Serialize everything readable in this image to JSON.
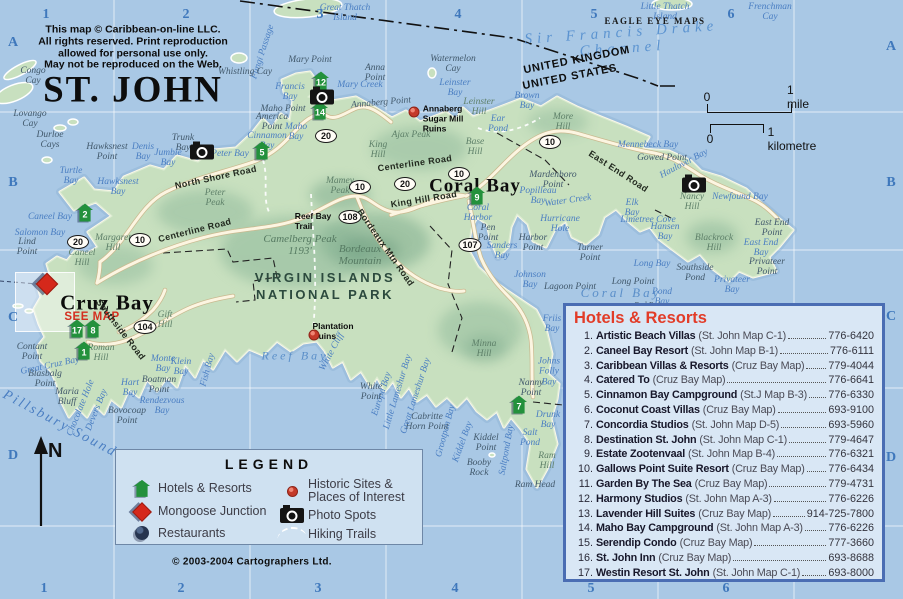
{
  "title": "ST. JOHN",
  "copyright_notice": "This map © Caribbean-on-line LLC.\nAll rights reserved. Print reproduction\nallowed for personal use only.\nMay not be reproduced on the Web.",
  "credit": "© 2003-2004 Cartographers Ltd.",
  "compass_n": "N",
  "colors": {
    "water": "#a9c8e5",
    "land": "#c8e0bf",
    "panel_bg": "#d9e7f5",
    "panel_border": "#4a6db3",
    "header_red": "#e23c28",
    "marker_green": "#23913c",
    "diamond_red": "#d5281b",
    "grid_label_blue": "#3f78bc",
    "water_label_blue": "#4a7ec2"
  },
  "scale_bar": {
    "mile_zero": "0",
    "mile_label": "1 mile",
    "km_zero": "0",
    "km_label": "1 kilometre"
  },
  "grid": {
    "cols": [
      "1",
      "2",
      "3",
      "4",
      "5",
      "6"
    ],
    "rows": [
      "A",
      "B",
      "C",
      "D"
    ],
    "top_xs": [
      46,
      186,
      320,
      458,
      594,
      731
    ],
    "top_y": 15,
    "bottom_xs": [
      44,
      181,
      318,
      455,
      591,
      726
    ],
    "bottom_y": 589,
    "left_x": 13,
    "left_ys": [
      43,
      183,
      318,
      456
    ],
    "right_x": 891,
    "right_ys": [
      47,
      183,
      317,
      458
    ]
  },
  "legend": {
    "title": "LEGEND",
    "left": [
      {
        "icon": "hotel-icon",
        "label": "Hotels & Resorts"
      },
      {
        "icon": "mongoose-junction-icon",
        "label": "Mongoose Junction"
      },
      {
        "icon": "restaurant-icon",
        "label": "Restaurants"
      }
    ],
    "right": [
      {
        "icon": "historic-site-icon",
        "label": "Historic Sites &\nPlaces of Interest"
      },
      {
        "icon": "photo-spot-icon",
        "label": "Photo Spots"
      },
      {
        "icon": "hiking-trail-icon",
        "label": "Hiking Trails"
      }
    ]
  },
  "hotels_panel": {
    "title": "Hotels & Resorts",
    "items": [
      {
        "num": "1.",
        "name": "Artistic Beach Villas",
        "note": "(St. John Map C-1)",
        "phone": "776-6420"
      },
      {
        "num": "2.",
        "name": "Caneel Bay Resort",
        "note": "(St. John Map B-1)",
        "phone": "776-6111"
      },
      {
        "num": "3.",
        "name": "Caribbean Villas & Resorts",
        "note": "(Cruz Bay Map)",
        "phone": "779-4044"
      },
      {
        "num": "4.",
        "name": "Catered To",
        "note": "(Cruz Bay Map)",
        "phone": "776-6641"
      },
      {
        "num": "5.",
        "name": "Cinnamon Bay Campground",
        "note": "(St.J Map B-3)",
        "phone": "776-6330"
      },
      {
        "num": "6.",
        "name": "Coconut Coast Villas",
        "note": "(Cruz Bay Map)",
        "phone": "693-9100"
      },
      {
        "num": "7.",
        "name": "Concordia Studios",
        "note": "(St. John Map D-5)",
        "phone": "693-5960"
      },
      {
        "num": "8.",
        "name": "Destination St. John",
        "note": "(St. John Map C-1)",
        "phone": "779-4647"
      },
      {
        "num": "9.",
        "name": "Estate Zootenvaal",
        "note": "(St. John Map B-4)",
        "phone": "776-6321"
      },
      {
        "num": "10.",
        "name": "Gallows Point Suite Resort",
        "note": "(Cruz Bay Map)",
        "phone": "776-6434"
      },
      {
        "num": "11.",
        "name": "Garden By The Sea",
        "note": "(Cruz Bay Map)",
        "phone": "779-4731"
      },
      {
        "num": "12.",
        "name": "Harmony Studios",
        "note": "(St. John Map A-3)",
        "phone": "776-6226"
      },
      {
        "num": "13.",
        "name": "Lavender Hill Suites",
        "note": "(Cruz Bay Map)",
        "phone": "914-725-7800"
      },
      {
        "num": "14.",
        "name": "Maho Bay Campground",
        "note": "(St. John Map A-3)",
        "phone": "776-6226"
      },
      {
        "num": "15.",
        "name": "Serendip Condo",
        "note": "(Cruz Bay Map)",
        "phone": "777-3660"
      },
      {
        "num": "16.",
        "name": "St. John Inn",
        "note": "(Cruz Bay Map)",
        "phone": "693-8688"
      },
      {
        "num": "17.",
        "name": "Westin Resort St. John",
        "note": "(St. John Map C-1)",
        "phone": "693-8000"
      }
    ]
  },
  "map": {
    "hotel_markers": [
      {
        "n": "1",
        "x": 84,
        "y": 352
      },
      {
        "n": "2",
        "x": 85,
        "y": 214
      },
      {
        "n": "5",
        "x": 262,
        "y": 152
      },
      {
        "n": "7",
        "x": 519,
        "y": 406
      },
      {
        "n": "8",
        "x": 93,
        "y": 330
      },
      {
        "n": "9",
        "x": 477,
        "y": 197
      },
      {
        "n": "12",
        "x": 321,
        "y": 82
      },
      {
        "n": "14",
        "x": 320,
        "y": 112
      },
      {
        "n": "17",
        "x": 77,
        "y": 330
      }
    ],
    "photo_spots": [
      {
        "x": 202,
        "y": 152
      },
      {
        "x": 322,
        "y": 97
      },
      {
        "x": 694,
        "y": 185
      }
    ],
    "historic_sites": [
      {
        "x": 414,
        "y": 112
      },
      {
        "x": 314,
        "y": 335
      }
    ],
    "mongoose_junction": {
      "x": 47,
      "y": 284
    },
    "road_badges": [
      {
        "n": "20",
        "x": 78,
        "y": 242
      },
      {
        "n": "10",
        "x": 140,
        "y": 240
      },
      {
        "n": "104",
        "x": 145,
        "y": 327
      },
      {
        "n": "20",
        "x": 326,
        "y": 136
      },
      {
        "n": "10",
        "x": 360,
        "y": 187
      },
      {
        "n": "108",
        "x": 350,
        "y": 217
      },
      {
        "n": "20",
        "x": 405,
        "y": 184
      },
      {
        "n": "10",
        "x": 459,
        "y": 174
      },
      {
        "n": "10",
        "x": 550,
        "y": 142
      },
      {
        "n": "107",
        "x": 470,
        "y": 245
      }
    ],
    "labels": [
      {
        "t": "Great Thatch\nIsland",
        "x": 345,
        "y": 13,
        "c": "water"
      },
      {
        "t": "Little Thatch\nIsland",
        "x": 665,
        "y": 12,
        "c": "water"
      },
      {
        "t": "Frenchman\nCay",
        "x": 770,
        "y": 12,
        "c": "water"
      },
      {
        "t": "Fungi Passage",
        "x": 263,
        "y": 52,
        "c": "water",
        "r": -72
      },
      {
        "t": "Whistling Cay",
        "x": 245,
        "y": 72,
        "c": "point"
      },
      {
        "t": "Mary Point",
        "x": 310,
        "y": 60,
        "c": "point"
      },
      {
        "t": "Anna\nPoint",
        "x": 375,
        "y": 73,
        "c": "point"
      },
      {
        "t": "Watermelon\nCay",
        "x": 453,
        "y": 64,
        "c": "point"
      },
      {
        "t": "Mary Creek",
        "x": 360,
        "y": 85,
        "c": "water"
      },
      {
        "t": "Leinster\nBay",
        "x": 455,
        "y": 88,
        "c": "water"
      },
      {
        "t": "Francis\nBay",
        "x": 290,
        "y": 92,
        "c": "water"
      },
      {
        "t": "Maho Point",
        "x": 283,
        "y": 109,
        "c": "point"
      },
      {
        "t": "Maho\nBay",
        "x": 296,
        "y": 132,
        "c": "water"
      },
      {
        "t": "America\nPoint",
        "x": 272,
        "y": 122,
        "c": "point"
      },
      {
        "t": "Cinnamon\nBay",
        "x": 267,
        "y": 141,
        "c": "water"
      },
      {
        "t": "Peter Bay",
        "x": 230,
        "y": 154,
        "c": "water"
      },
      {
        "t": "Trunk\nBay",
        "x": 183,
        "y": 143,
        "c": "point"
      },
      {
        "t": "Jumbie\nBay",
        "x": 168,
        "y": 158,
        "c": "water"
      },
      {
        "t": "Denis\nBay",
        "x": 143,
        "y": 152,
        "c": "water"
      },
      {
        "t": "Hawksnest\nPoint",
        "x": 107,
        "y": 152,
        "c": "point"
      },
      {
        "t": "Turtle\nBay",
        "x": 71,
        "y": 176,
        "c": "water"
      },
      {
        "t": "Hawksnest\nBay",
        "x": 118,
        "y": 187,
        "c": "water"
      },
      {
        "t": "Congo\nCay",
        "x": 33,
        "y": 76,
        "c": "point"
      },
      {
        "t": "Lovango\nCay",
        "x": 30,
        "y": 119,
        "c": "point"
      },
      {
        "t": "Durloe\nCays",
        "x": 50,
        "y": 140,
        "c": "point"
      },
      {
        "t": "Caneel Bay",
        "x": 50,
        "y": 217,
        "c": "water"
      },
      {
        "t": "Salomon Bay",
        "x": 40,
        "y": 233,
        "c": "water"
      },
      {
        "t": "Lind\nPoint",
        "x": 27,
        "y": 247,
        "c": "point"
      },
      {
        "t": "Caneel\nHill",
        "x": 82,
        "y": 258,
        "c": "hill"
      },
      {
        "t": "Margaret\nHill",
        "x": 113,
        "y": 243,
        "c": "hill"
      },
      {
        "t": "Peter\nPeak",
        "x": 215,
        "y": 198,
        "c": "hill"
      },
      {
        "t": "Annaberg Point",
        "x": 381,
        "y": 103,
        "c": "point",
        "r": -5
      },
      {
        "t": "Leinster\nHill",
        "x": 479,
        "y": 107,
        "c": "hill"
      },
      {
        "t": "Ear\nPond",
        "x": 498,
        "y": 124,
        "c": "water"
      },
      {
        "t": "Brown\nBay",
        "x": 527,
        "y": 101,
        "c": "water"
      },
      {
        "t": "More\nHill",
        "x": 563,
        "y": 122,
        "c": "hill"
      },
      {
        "t": "Base\nHill",
        "x": 475,
        "y": 147,
        "c": "hill"
      },
      {
        "t": "Ajax Peak",
        "x": 411,
        "y": 135,
        "c": "hill"
      },
      {
        "t": "King\nHill",
        "x": 378,
        "y": 150,
        "c": "hill"
      },
      {
        "t": "Mamey\nPeak",
        "x": 340,
        "y": 186,
        "c": "hill"
      },
      {
        "t": "Camelberg Peak\n1193'",
        "x": 300,
        "y": 246,
        "c": "hillbig"
      },
      {
        "t": "Bordeaux\nMountain",
        "x": 360,
        "y": 256,
        "c": "hillbig"
      },
      {
        "t": "Mennebeck Bay",
        "x": 648,
        "y": 145,
        "c": "water"
      },
      {
        "t": "Gowed Point",
        "x": 662,
        "y": 158,
        "c": "point"
      },
      {
        "t": "Haulover Bay",
        "x": 684,
        "y": 164,
        "c": "water",
        "r": -28
      },
      {
        "t": "Nancy\nHill",
        "x": 692,
        "y": 202,
        "c": "hill"
      },
      {
        "t": "Newfound Bay",
        "x": 740,
        "y": 197,
        "c": "water"
      },
      {
        "t": "Blackrock\nHill",
        "x": 714,
        "y": 243,
        "c": "hill"
      },
      {
        "t": "East End\nPoint",
        "x": 772,
        "y": 228,
        "c": "point"
      },
      {
        "t": "East End\nBay",
        "x": 761,
        "y": 248,
        "c": "water"
      },
      {
        "t": "Privateer\nPoint",
        "x": 767,
        "y": 267,
        "c": "point"
      },
      {
        "t": "Privateer\nBay",
        "x": 732,
        "y": 285,
        "c": "water"
      },
      {
        "t": "Hansen\nBay",
        "x": 665,
        "y": 232,
        "c": "water"
      },
      {
        "t": "Limetree Cove",
        "x": 648,
        "y": 220,
        "c": "water"
      },
      {
        "t": "Elk\nBay",
        "x": 632,
        "y": 208,
        "c": "water"
      },
      {
        "t": "Long Bay",
        "x": 652,
        "y": 264,
        "c": "water"
      },
      {
        "t": "Southside\nPond",
        "x": 695,
        "y": 273,
        "c": "point"
      },
      {
        "t": "Pond\nBay",
        "x": 662,
        "y": 297,
        "c": "water"
      },
      {
        "t": "Red Point",
        "x": 650,
        "y": 306,
        "c": "point",
        "s": 8
      },
      {
        "t": "Water Creek",
        "x": 568,
        "y": 201,
        "c": "water",
        "r": -8
      },
      {
        "t": "Popilleau\nBay",
        "x": 538,
        "y": 196,
        "c": "water"
      },
      {
        "t": "Mardenboro\nPoint",
        "x": 553,
        "y": 180,
        "c": "point"
      },
      {
        "t": "Hurricane\nHole",
        "x": 560,
        "y": 224,
        "c": "water"
      },
      {
        "t": "Harbor\nPoint",
        "x": 533,
        "y": 243,
        "c": "point"
      },
      {
        "t": "Turner\nPoint",
        "x": 590,
        "y": 253,
        "c": "point"
      },
      {
        "t": "Sanders\nBay",
        "x": 502,
        "y": 251,
        "c": "water"
      },
      {
        "t": "Pen\nPoint",
        "x": 488,
        "y": 233,
        "c": "point"
      },
      {
        "t": "Coral\nHarbor",
        "x": 478,
        "y": 213,
        "c": "water"
      },
      {
        "t": "Johnson\nBay",
        "x": 530,
        "y": 280,
        "c": "water"
      },
      {
        "t": "Lagoon Point",
        "x": 570,
        "y": 287,
        "c": "point"
      },
      {
        "t": "Long Point",
        "x": 633,
        "y": 282,
        "c": "point"
      },
      {
        "t": "Coral Bay",
        "x": 621,
        "y": 293,
        "c": "waterbig"
      },
      {
        "t": "Friis\nBay",
        "x": 552,
        "y": 324,
        "c": "water"
      },
      {
        "t": "Minna\nHill",
        "x": 484,
        "y": 349,
        "c": "hill"
      },
      {
        "t": "Johns\nFolly\nBay",
        "x": 549,
        "y": 372,
        "c": "water"
      },
      {
        "t": "Nanny\nPoint",
        "x": 531,
        "y": 388,
        "c": "point"
      },
      {
        "t": "Drunk\nBay",
        "x": 548,
        "y": 420,
        "c": "water"
      },
      {
        "t": "Salt\nPond",
        "x": 530,
        "y": 438,
        "c": "water"
      },
      {
        "t": "Ram\nHill",
        "x": 547,
        "y": 461,
        "c": "hill"
      },
      {
        "t": "Ram Head",
        "x": 535,
        "y": 485,
        "c": "point"
      },
      {
        "t": "Saltpond Bay",
        "x": 507,
        "y": 450,
        "c": "water",
        "r": -80
      },
      {
        "t": "Kiddel\nPoint",
        "x": 486,
        "y": 443,
        "c": "point"
      },
      {
        "t": "Booby\nRock",
        "x": 479,
        "y": 468,
        "c": "point"
      },
      {
        "t": "Kiddel Bay",
        "x": 463,
        "y": 442,
        "c": "water",
        "r": -70
      },
      {
        "t": "Grootpan Bay",
        "x": 446,
        "y": 431,
        "c": "water",
        "r": -75
      },
      {
        "t": "Cabritte\nHorn Point",
        "x": 427,
        "y": 422,
        "c": "point"
      },
      {
        "t": "Great Lameshur Bay",
        "x": 416,
        "y": 396,
        "c": "water",
        "r": -72
      },
      {
        "t": "Little Lameshur Bay",
        "x": 398,
        "y": 392,
        "c": "water",
        "r": -73
      },
      {
        "t": "Europa Bay",
        "x": 382,
        "y": 394,
        "c": "water",
        "r": -72
      },
      {
        "t": "White\nPoint",
        "x": 371,
        "y": 392,
        "c": "point"
      },
      {
        "t": "White Cliff",
        "x": 332,
        "y": 352,
        "c": "water",
        "r": -62
      },
      {
        "t": "Reef Bay",
        "x": 295,
        "y": 356,
        "c": "waterbig",
        "s": 12
      },
      {
        "t": "Fish Bay",
        "x": 208,
        "y": 370,
        "c": "water",
        "r": -75
      },
      {
        "t": "Monte\nBay",
        "x": 163,
        "y": 364,
        "c": "water"
      },
      {
        "t": "Klein\nBay",
        "x": 181,
        "y": 367,
        "c": "water"
      },
      {
        "t": "Rendezvous\nBay",
        "x": 162,
        "y": 406,
        "c": "water"
      },
      {
        "t": "Hart\nBay",
        "x": 130,
        "y": 388,
        "c": "water"
      },
      {
        "t": "Boatman\nPoint",
        "x": 159,
        "y": 385,
        "c": "point"
      },
      {
        "t": "Bovocoap\nPoint",
        "x": 127,
        "y": 416,
        "c": "point"
      },
      {
        "t": "Devers Bay",
        "x": 97,
        "y": 410,
        "c": "water",
        "r": -68
      },
      {
        "t": "Chocolate Hole",
        "x": 81,
        "y": 408,
        "c": "water",
        "r": -68
      },
      {
        "t": "Maria\nBluff",
        "x": 67,
        "y": 397,
        "c": "point"
      },
      {
        "t": "Blasbalg\nPoint",
        "x": 45,
        "y": 379,
        "c": "point"
      },
      {
        "t": "Great Cruz Bay",
        "x": 50,
        "y": 366,
        "c": "water",
        "r": -12
      },
      {
        "t": "Contant\nPoint",
        "x": 32,
        "y": 352,
        "c": "point"
      },
      {
        "t": "Roman\nHill",
        "x": 101,
        "y": 353,
        "c": "hill"
      },
      {
        "t": "Gift\nHill",
        "x": 165,
        "y": 320,
        "c": "hill"
      },
      {
        "t": "Cruz Bay",
        "x": 107,
        "y": 303,
        "c": "town"
      },
      {
        "t": "SEE MAP",
        "x": 92,
        "y": 317,
        "c": "seemap"
      },
      {
        "t": "Coral Bay",
        "x": 475,
        "y": 187,
        "c": "town",
        "s": 19
      },
      {
        "t": "VIRGIN ISLANDS\nNATIONAL PARK",
        "x": 325,
        "y": 287,
        "c": "park"
      },
      {
        "t": "Sir Francis Drake Channel",
        "x": 622,
        "y": 41,
        "c": "channel",
        "r": -4
      },
      {
        "t": "Pillsbury Sound",
        "x": 60,
        "y": 424,
        "c": "sound",
        "r": 28
      },
      {
        "t": "UNITED KINGDOM",
        "x": 577,
        "y": 61,
        "c": "country",
        "r": -11
      },
      {
        "t": "UNITED STATES",
        "x": 570,
        "y": 78,
        "c": "country",
        "r": -11
      },
      {
        "t": "EAGLE EYE MAPS",
        "x": 655,
        "y": 22,
        "c": "pub"
      },
      {
        "t": "North Shore Road",
        "x": 216,
        "y": 178,
        "c": "road",
        "r": -12
      },
      {
        "t": "Centerline Road",
        "x": 195,
        "y": 231,
        "c": "road",
        "r": -14
      },
      {
        "t": "Centerline Road",
        "x": 415,
        "y": 164,
        "c": "road",
        "r": -8
      },
      {
        "t": "King Hill Road",
        "x": 424,
        "y": 200,
        "c": "road",
        "r": -9
      },
      {
        "t": "East End Road",
        "x": 618,
        "y": 172,
        "c": "road",
        "r": 33
      },
      {
        "t": "Southside Road",
        "x": 120,
        "y": 330,
        "c": "road",
        "r": 52
      },
      {
        "t": "Bordeaux Mtn Road",
        "x": 385,
        "y": 248,
        "c": "road",
        "r": 55
      },
      {
        "t": "Reef Bay\nTrail",
        "x": 313,
        "y": 222,
        "c": "poi"
      },
      {
        "t": "Annaberg\nSugar Mill\nRuins",
        "x": 443,
        "y": 119,
        "c": "poi"
      },
      {
        "t": "Plantation\nRuins",
        "x": 333,
        "y": 332,
        "c": "poi"
      }
    ]
  }
}
